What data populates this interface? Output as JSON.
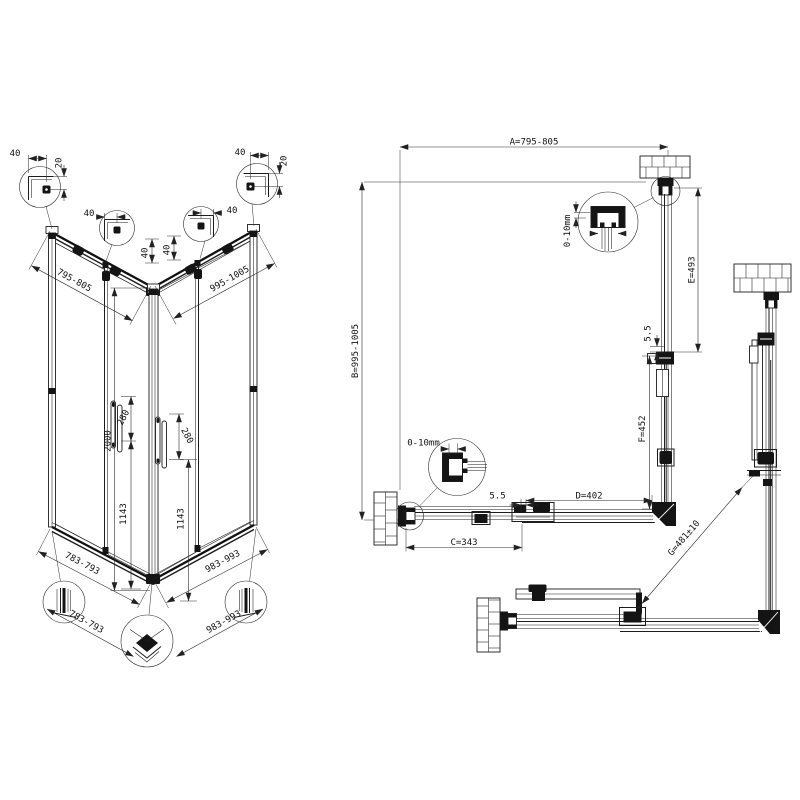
{
  "drawing": {
    "isometric": {
      "top_width_left": "795-805",
      "top_width_right": "995-1005",
      "overall_height": "2000",
      "handle_length_left": "280",
      "handle_length_right": "280",
      "handle_clearance_left": "1143",
      "handle_clearance_right": "1143",
      "base_width_left": "783-793",
      "base_width_right": "983-993",
      "profile_width_left": "783-793",
      "profile_width_right": "983-993",
      "detail_top_left": {
        "width": "40",
        "inset": "20"
      },
      "detail_mid_left": {
        "width": "40",
        "inset": "40"
      },
      "detail_mid_right": {
        "width": "40",
        "inset": "40"
      },
      "detail_top_right": {
        "width": "40",
        "inset": "20"
      }
    },
    "plan": {
      "width": "A=795-805",
      "depth": "B=995-1005",
      "fixed_panel_bottom": "C=343",
      "door_bottom": "D=402",
      "fixed_panel_right": "E=493",
      "door_right": "F=452",
      "gap_right": "5.5",
      "gap_bottom": "5.5",
      "wall_adjust_right": "0-10mm",
      "wall_adjust_bottom": "0-10mm"
    },
    "corner_view": {
      "diagonal_entry": "G=481±10"
    }
  }
}
